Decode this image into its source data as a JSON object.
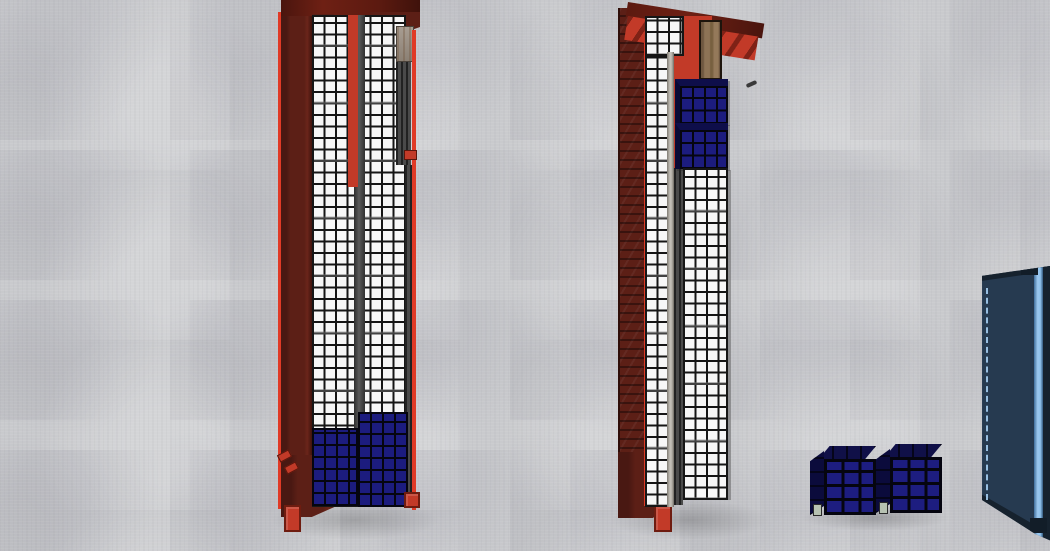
{
  "scene": {
    "type": "3d-viewport",
    "description": "Top-down 3D view of shipping containers loaded with boxes on a concrete floor",
    "objects": [
      {
        "id": "container-left",
        "kind": "shipping-container",
        "body_color_name": "red",
        "cargo": [
          "white-box-grid",
          "blue-boxes-at-bottom"
        ],
        "doors": "open-top"
      },
      {
        "id": "container-middle",
        "kind": "shipping-container",
        "body_color_name": "red",
        "cargo": [
          "white-box-grid",
          "two-blue-box-stacks-upper-right",
          "wood-floor-panel-visible"
        ]
      },
      {
        "id": "container-blue-partial",
        "kind": "shipping-container",
        "body_color_name": "blue",
        "note": "partially visible at right edge"
      },
      {
        "id": "blue-box-stack-1",
        "kind": "pallet-stack",
        "body_color_name": "navy",
        "front_grid": "3x4"
      },
      {
        "id": "blue-box-stack-2",
        "kind": "pallet-stack",
        "body_color_name": "navy",
        "front_grid": "3x4"
      }
    ]
  },
  "colors": {
    "floor": "#c9cacd",
    "container-red": "#c23a28",
    "container-maroon": "#5c1f16",
    "accent-red": "#e03a26",
    "box-white": "#f7f7f7",
    "grid-line": "#161616",
    "box-blue": "#1c1c7e",
    "box-line": "#05050f",
    "container-blue-body": "#263a50",
    "container-blue-stripe": "#9cc9f0",
    "container-blue-dark": "#16222e",
    "wood": "#8d7356",
    "rust-panel": "#9e948a",
    "silver-rail": "#b9b5ae",
    "pallet-foot": "#b7c2b2"
  }
}
